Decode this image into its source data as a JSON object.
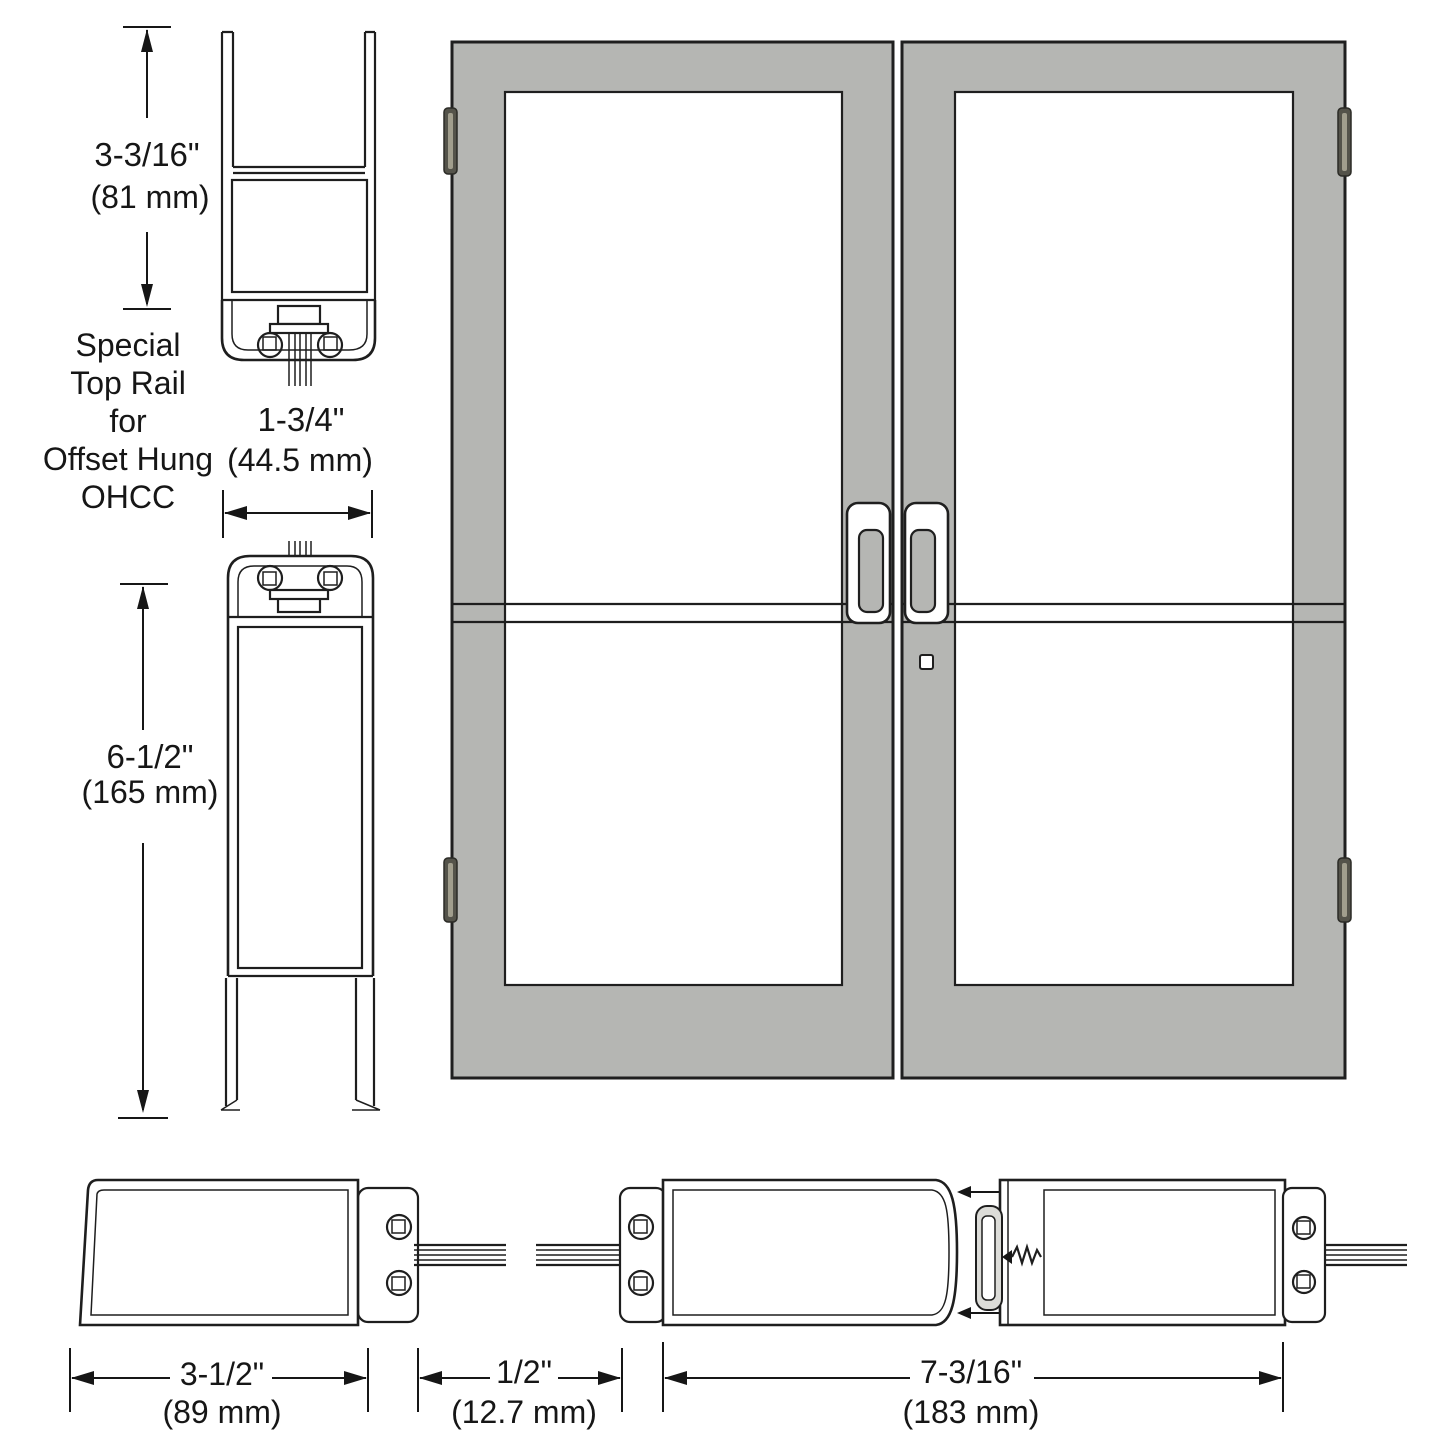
{
  "note": {
    "lines": [
      "Special",
      "Top Rail",
      "for",
      "Offset Hung",
      "OHCC"
    ]
  },
  "dims": {
    "rail_top": {
      "in": "3-3/16\"",
      "mm": "(81 mm)"
    },
    "rail_top_width": {
      "in": "1-3/4\"",
      "mm": "(44.5 mm)"
    },
    "rail_bottom": {
      "in": "6-1/2\"",
      "mm": "(165 mm)"
    },
    "stile": {
      "in": "3-1/2\"",
      "mm": "(89 mm)"
    },
    "glass_gap": {
      "in": "1/2\"",
      "mm": "(12.7 mm)"
    },
    "meeting_stiles": {
      "in": "7-3/16\"",
      "mm": "(183 mm)"
    }
  },
  "colors": {
    "door_fill": "#b5b6b3",
    "glass_fill": "#ffffff",
    "line": "#1e1e1e",
    "hinge_body": "#54534a",
    "hinge_highlight": "#a19e8d",
    "gasket_fill": "#dcdcd8"
  }
}
